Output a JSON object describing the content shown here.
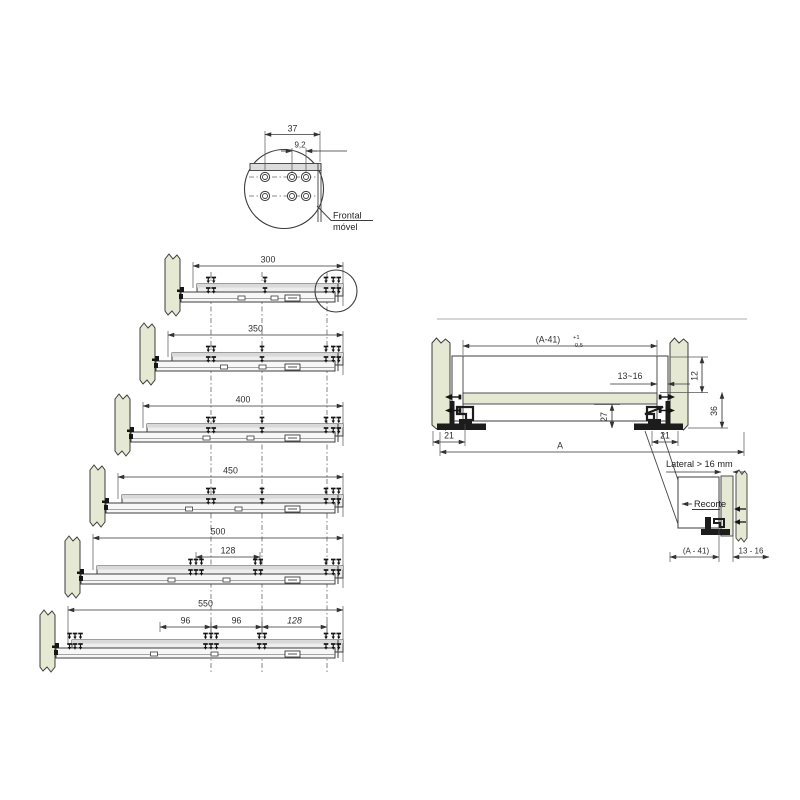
{
  "drawing": {
    "top_detail": {
      "dim_width": "37",
      "dim_offset": "9,2",
      "label_line1": "Frontal",
      "label_line2": "móvel"
    },
    "slide_rows": [
      {
        "length_label": "300",
        "sub_dims": []
      },
      {
        "length_label": "350",
        "sub_dims": []
      },
      {
        "length_label": "400",
        "sub_dims": []
      },
      {
        "length_label": "450",
        "sub_dims": []
      },
      {
        "length_label": "500",
        "sub_dims": [
          "128"
        ]
      },
      {
        "length_label": "550",
        "sub_dims": [
          "96",
          "96",
          "128"
        ]
      }
    ],
    "cross_section": {
      "dim_inner_width": "(A-41)",
      "tol_plus": "+1",
      "tol_minus": "-0,5",
      "dim_side_thickness": "13~16",
      "dim_top_offset": "12",
      "dim_height": "36",
      "dim_depth": "27",
      "dim_left_gap": "21",
      "dim_right_gap": "21",
      "dim_total_width": "A"
    },
    "lateral_detail": {
      "label_lateral": "Lateral > 16 mm",
      "label_recorte": "Recorte",
      "dim_width": "(A - 41)",
      "dim_thickness": "13 - 16"
    },
    "colors": {
      "panel_green": "#e5e9d3",
      "outline": "#3c3c3c",
      "slide_fill": "#efefef",
      "dim_color": "#333333"
    }
  }
}
